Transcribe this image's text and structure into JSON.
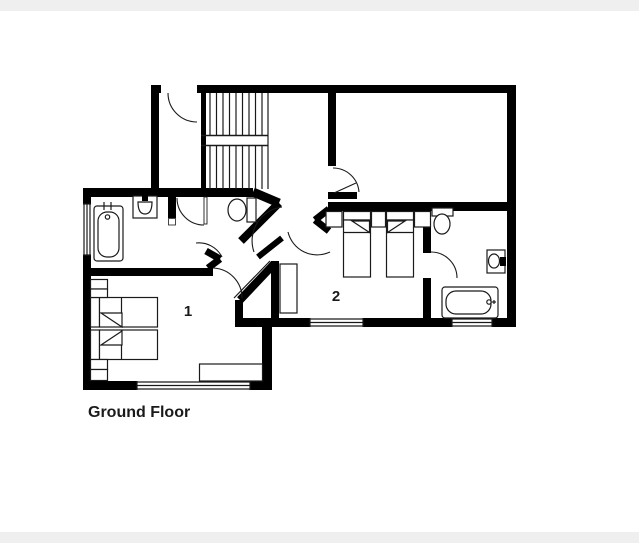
{
  "page": {
    "background": "#ffffff",
    "top_band_color": "#efefef",
    "bottom_band_color": "#efefef"
  },
  "floor_plan": {
    "caption": "Ground Floor",
    "rooms": [
      {
        "name": "bedroom-1",
        "label": "1"
      },
      {
        "name": "bedroom-2",
        "label": "2"
      }
    ],
    "colors": {
      "walls": "#000000",
      "floor": "#ffffff",
      "lines": "#1a1a1a"
    },
    "fixtures": [
      "staircase",
      "bathtub-left",
      "sink-left",
      "toilet-wc",
      "toilet-right",
      "sink-right",
      "bathtub-right",
      "single-bed",
      "nightstand",
      "wardrobe",
      "desk",
      "window",
      "door-swing"
    ]
  }
}
